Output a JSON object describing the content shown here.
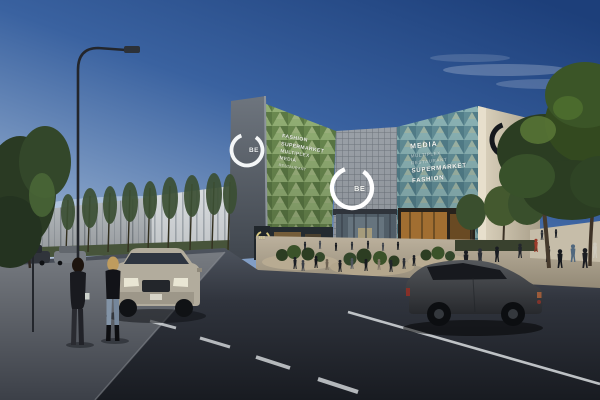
{
  "scene": {
    "description": "Dusk architectural rendering of the BE shopping mall: faceted green glass facades, concrete tower with ring logo, street with cars and pedestrians"
  },
  "branding": {
    "tower_logo": "BE",
    "entrance_logo": "BE",
    "storefront_sign": "BE"
  },
  "left_facade_text": {
    "line1": "FASHION",
    "line2": "SUPERMARKET",
    "line3": "MULTIPLEX",
    "line4": "MEDIA",
    "line5": "RESTAURANT"
  },
  "right_facade_text": {
    "line1": "MEDIA",
    "line2": "MULTIPLEX",
    "line3": "RESTAURANT",
    "line4": "SUPERMARKET",
    "line5": "FASHION"
  },
  "colors": {
    "sky_top": "#1d3f7a",
    "sky_horizon": "#b7c6d8",
    "green_facade": "#7d9a60",
    "teal_facade": "#6f98a2",
    "concrete": "#9aa0a7",
    "road": "#23262e",
    "logo_white": "#ffffff"
  }
}
